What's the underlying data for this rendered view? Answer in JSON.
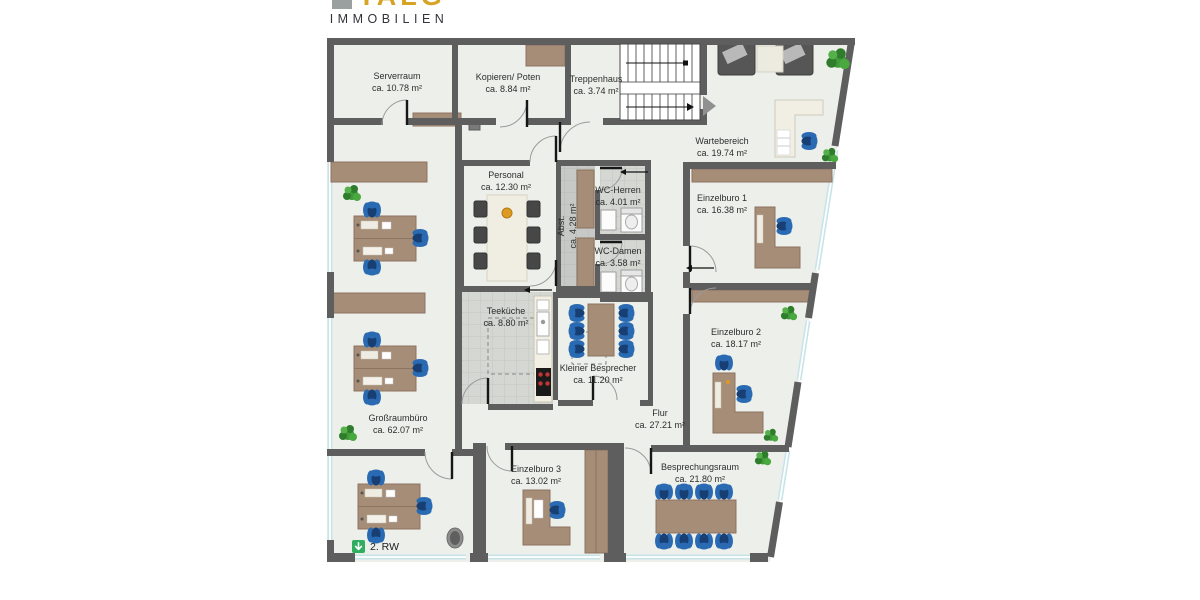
{
  "brand": {
    "logo_mark": "TALG",
    "subtitle": "IMMOBILIEN"
  },
  "plan": {
    "legend": {
      "escape_route": "2. RW"
    },
    "rooms": {
      "serverraum": {
        "name": "Serverraum",
        "area": "ca. 10.78 m²"
      },
      "kopieren": {
        "name": "Kopieren/ Poten",
        "area": "ca. 8.84 m²"
      },
      "treppenhaus": {
        "name": "Treppenhaus",
        "area": "ca. 3.74 m²"
      },
      "wartebereich": {
        "name": "Wartebereich",
        "area": "ca. 19.74 m²"
      },
      "personal": {
        "name": "Personal",
        "area": "ca. 12.30 m²"
      },
      "abst": {
        "name": "Abst.",
        "area": "ca. 4.28 m²"
      },
      "wc_herren": {
        "name": "WC-Herren",
        "area": "ca. 4.01 m²"
      },
      "wc_damen": {
        "name": "WC-Damen",
        "area": "ca. 3.58 m²"
      },
      "einzelburo1": {
        "name": "Einzelburo 1",
        "area": "ca. 16.38 m²"
      },
      "einzelburo2": {
        "name": "Einzelburo 2",
        "area": "ca. 18.17 m²"
      },
      "teekueche": {
        "name": "Teeküche",
        "area": "ca. 8.80 m²"
      },
      "kleiner_besprecher": {
        "name": "Kleiner Besprecher",
        "area": "ca. 11.20 m²"
      },
      "grossraumbuero": {
        "name": "Großraumbüro",
        "area": "ca. 62.07 m²"
      },
      "flur": {
        "name": "Flur",
        "area": "ca. 27.21 m²"
      },
      "einzelburo3": {
        "name": "Einzelburo 3",
        "area": "ca. 13.02 m²"
      },
      "besprechungsraum": {
        "name": "Besprechungsraum",
        "area": "ca. 21.80 m²"
      }
    },
    "colors": {
      "wall": "#5e5e5e",
      "floor": "#edf0ea",
      "wood": "#a68d77",
      "chair_blue": "#2a6ab2",
      "window": "#c8e4e8",
      "tile": "#d5d7d3",
      "plant_green": "#3f9b3a",
      "logo_gold": "#d7a325",
      "escape_green": "#2fae60"
    }
  }
}
